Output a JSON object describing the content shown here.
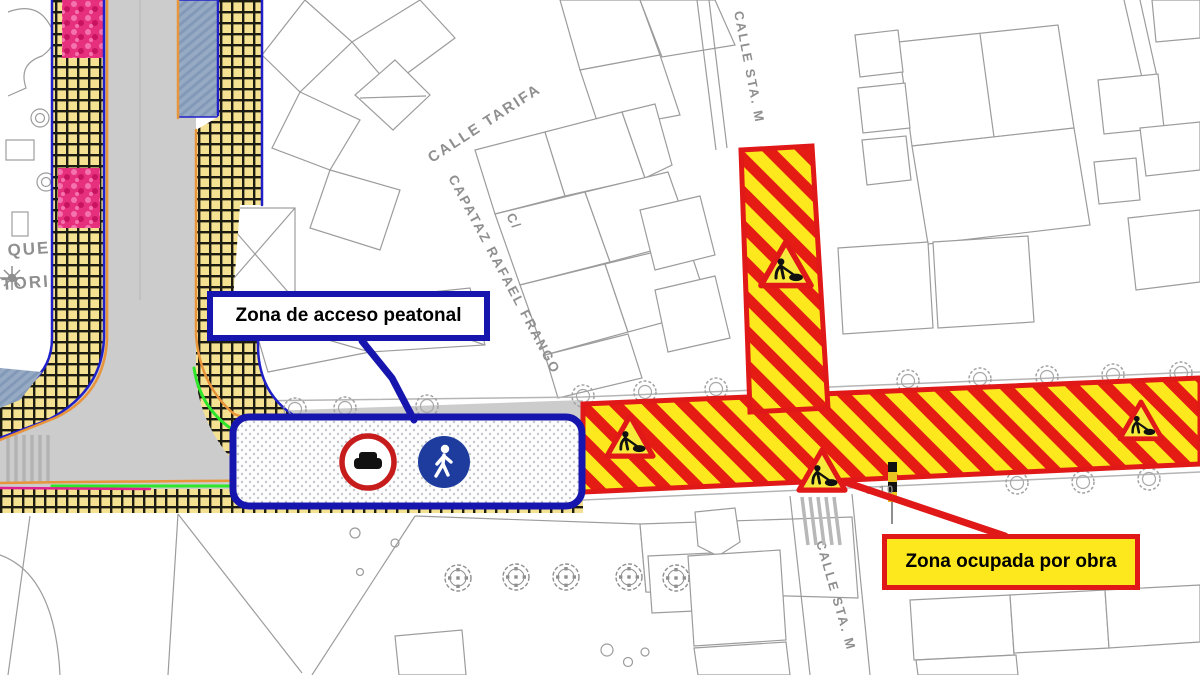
{
  "labels": {
    "pedestrian_access": "Zona de acceso peatonal",
    "construction": "Zona ocupada por obra"
  },
  "streets": {
    "tarifa": "CALLE TARIFA",
    "c_slash": "C/",
    "capataz": "CAPATAZ RAFAEL FRANGO",
    "sta_m_top": "CALLE STA. M",
    "sta_m_bottom": "CALLE STA. M",
    "parque_fragment_1": "QUE",
    "parque_fragment_2": "TORIA",
    "ref": "J 10"
  },
  "icons": {
    "no_vehicles": "no-vehicles-sign-icon",
    "pedestrian": "pedestrian-zone-sign-icon",
    "roadworks": "roadworks-warning-icon",
    "tree": "tree-icon"
  },
  "colors": {
    "zone_blue": "#1616ae",
    "zone_red": "#e01818",
    "band_yellow": "#fce81c",
    "checker_yellow": "#f4e292",
    "road_gray": "#cccccc",
    "parking_blue": "#96aac4",
    "flower_pink": "#e6307e",
    "curb_orange": "#e8943a",
    "kerb_green": "#2ee62a",
    "map_line_gray": "#9c9c9c",
    "street_text_gray": "#8f8f8f"
  }
}
